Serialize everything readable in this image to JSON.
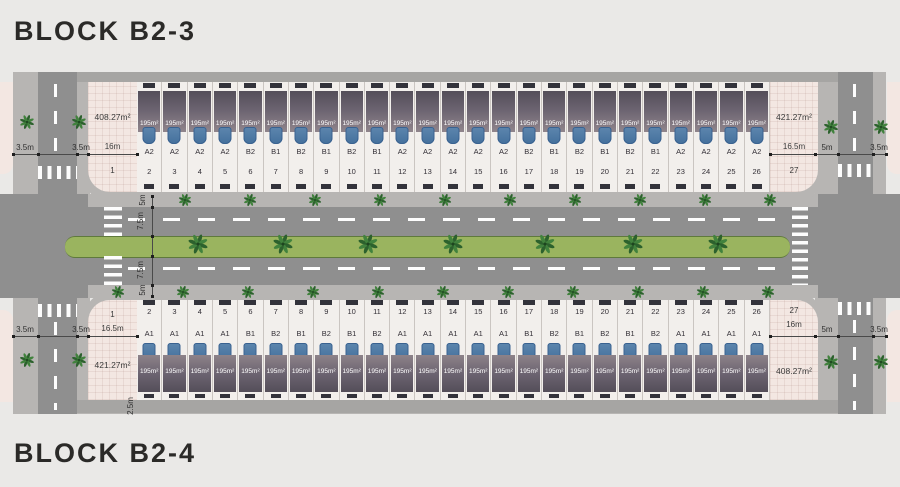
{
  "titles": {
    "block_top": "BLOCK B2-3",
    "block_bottom": "BLOCK B2-4"
  },
  "blocks": {
    "top": {
      "name": "B2-3",
      "corner_left": {
        "number": "1",
        "width": "16m",
        "area": "408.27m²"
      },
      "corner_right": {
        "number": "27",
        "width": "16.5m",
        "area": "421.27m²"
      },
      "lot_area": "195m²",
      "lots": [
        {
          "n": "2",
          "t": "A2"
        },
        {
          "n": "3",
          "t": "A2"
        },
        {
          "n": "4",
          "t": "A2"
        },
        {
          "n": "5",
          "t": "A2"
        },
        {
          "n": "6",
          "t": "B2"
        },
        {
          "n": "7",
          "t": "B1"
        },
        {
          "n": "8",
          "t": "B2"
        },
        {
          "n": "9",
          "t": "B1"
        },
        {
          "n": "10",
          "t": "B2"
        },
        {
          "n": "11",
          "t": "B1"
        },
        {
          "n": "12",
          "t": "A2"
        },
        {
          "n": "13",
          "t": "A2"
        },
        {
          "n": "14",
          "t": "A2"
        },
        {
          "n": "15",
          "t": "A2"
        },
        {
          "n": "16",
          "t": "A2"
        },
        {
          "n": "17",
          "t": "B2"
        },
        {
          "n": "18",
          "t": "B1"
        },
        {
          "n": "19",
          "t": "B2"
        },
        {
          "n": "20",
          "t": "B1"
        },
        {
          "n": "21",
          "t": "B2"
        },
        {
          "n": "22",
          "t": "B1"
        },
        {
          "n": "23",
          "t": "A2"
        },
        {
          "n": "24",
          "t": "A2"
        },
        {
          "n": "25",
          "t": "A2"
        },
        {
          "n": "26",
          "t": "A2"
        }
      ]
    },
    "bottom": {
      "name": "B2-4",
      "corner_left": {
        "number": "1",
        "width": "16.5m",
        "area": "421.27m²"
      },
      "corner_right": {
        "number": "27",
        "width": "16m",
        "area": "408.27m²"
      },
      "lot_area": "195m²",
      "lots": [
        {
          "n": "2",
          "t": "A1"
        },
        {
          "n": "3",
          "t": "A1"
        },
        {
          "n": "4",
          "t": "A1"
        },
        {
          "n": "5",
          "t": "A1"
        },
        {
          "n": "6",
          "t": "B1"
        },
        {
          "n": "7",
          "t": "B2"
        },
        {
          "n": "8",
          "t": "B1"
        },
        {
          "n": "9",
          "t": "B2"
        },
        {
          "n": "10",
          "t": "B1"
        },
        {
          "n": "11",
          "t": "B2"
        },
        {
          "n": "12",
          "t": "A1"
        },
        {
          "n": "13",
          "t": "A1"
        },
        {
          "n": "14",
          "t": "A1"
        },
        {
          "n": "15",
          "t": "A1"
        },
        {
          "n": "16",
          "t": "A1"
        },
        {
          "n": "17",
          "t": "B1"
        },
        {
          "n": "18",
          "t": "B2"
        },
        {
          "n": "19",
          "t": "B1"
        },
        {
          "n": "20",
          "t": "B2"
        },
        {
          "n": "21",
          "t": "B1"
        },
        {
          "n": "22",
          "t": "B2"
        },
        {
          "n": "23",
          "t": "A1"
        },
        {
          "n": "24",
          "t": "A1"
        },
        {
          "n": "25",
          "t": "A1"
        },
        {
          "n": "26",
          "t": "A1"
        }
      ]
    }
  },
  "dims": {
    "road_left": {
      "outer": "3.5m",
      "inner": "3.5m"
    },
    "road_right": {
      "inner": "5m",
      "outer": "3.5m"
    },
    "mid_road": [
      "5m",
      "7.5m",
      "7.5m",
      "5m"
    ],
    "rear_lane": "2.5m"
  },
  "colors": {
    "background": "#eae9e7",
    "road": "#8f8f8f",
    "sidewalk": "#b7b5b3",
    "rear_lane": "#a6a5a3",
    "median_green": "#9ab45f",
    "palm_green": "#2c612d",
    "lot_pink": "#f3e7e2",
    "lot_light": "#f2efec",
    "roof_dark": "#544e59",
    "roof_light": "#90858c",
    "car_blue": "#44709c",
    "text": "#2f2f2f"
  }
}
